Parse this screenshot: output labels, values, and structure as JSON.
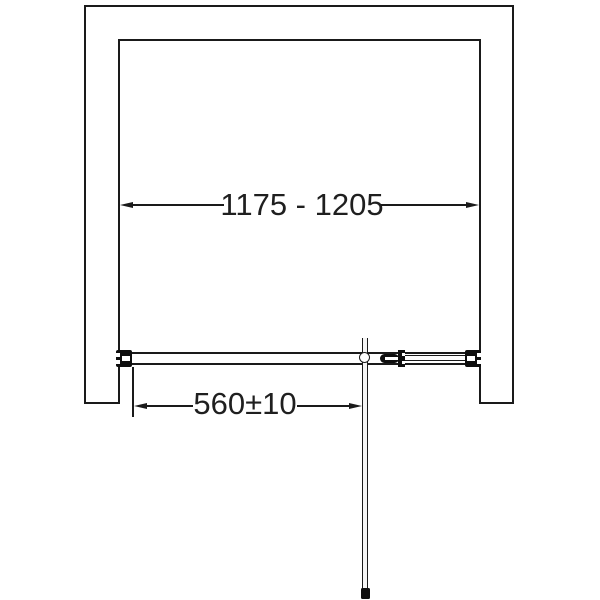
{
  "diagram": {
    "width_dimension": {
      "label": "1175 - 1205"
    },
    "offset_dimension": {
      "label": "560±10"
    },
    "colors": {
      "line": "#1a1a1a",
      "text": "#1f1f1f",
      "background": "#ffffff",
      "hardware": "#0e0e0e"
    }
  }
}
